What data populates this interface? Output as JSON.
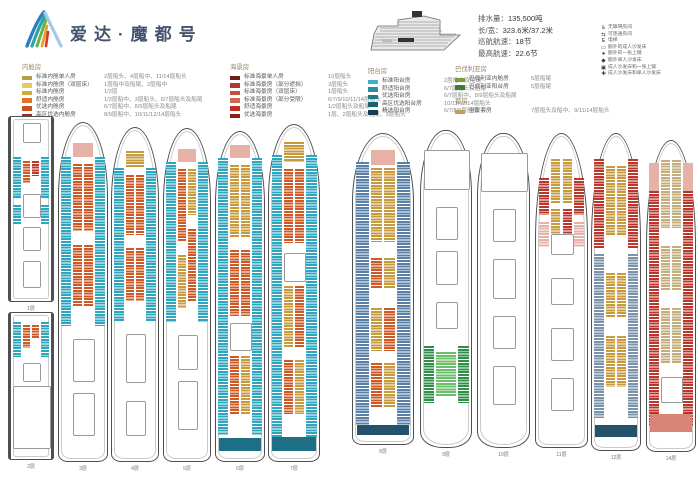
{
  "header": {
    "title": "爱达·魔都号",
    "specs": [
      {
        "label": "排水量：",
        "value": "135,500吨"
      },
      {
        "label": "长/宽：",
        "value": "323.6米/37.2米"
      },
      {
        "label": "巡航航速：",
        "value": "18节"
      },
      {
        "label": "最高航速：",
        "value": "22.6节"
      }
    ],
    "icon_legend": [
      {
        "icon": "wheelchair-icon",
        "glyph": "♿",
        "label": "无障碍房间"
      },
      {
        "icon": "connecting-rooms-icon",
        "glyph": "⇆",
        "label": "可连通房间"
      },
      {
        "icon": "elevator-icon",
        "glyph": "E",
        "label": "电梯"
      },
      {
        "icon": "sofa-bed-icon",
        "glyph": "▭",
        "label": "额外的成人沙发床"
      },
      {
        "icon": "upper-berth-icon",
        "glyph": "●",
        "label": "额外的一张上铺"
      },
      {
        "icon": "single-sofa-bed-icon",
        "glyph": "◆",
        "label": "额外单人沙发床"
      },
      {
        "icon": "sofa-and-berth-icon",
        "glyph": "▣",
        "label": "成人沙发床和一张上铺"
      },
      {
        "icon": "sofa-and-single-icon",
        "glyph": "✚",
        "label": "成人沙发床和单人沙发床"
      }
    ]
  },
  "legend_groups": [
    {
      "title": "内舱房",
      "items": [
        {
          "color": "#b2a040",
          "label": "标准内舱单人房",
          "desc": "2层船头、4层船中、11/14层船头"
        },
        {
          "color": "#e2cd58",
          "label": "标准内舱房（双层床）",
          "desc": "1层船中及船尾、2层船中"
        },
        {
          "color": "#d5a63a",
          "label": "标准内舱房",
          "desc": "1/2层"
        },
        {
          "color": "#dd7429",
          "label": "舒适内舱房",
          "desc": "1/2层船中、3层船头、6/7层船头及船尾"
        },
        {
          "color": "#c4521f",
          "label": "优选内舱房",
          "desc": "6/7层船中、8/9层船头及船尾"
        },
        {
          "color": "#9e2b1b",
          "label": "高区优选内舱房",
          "desc": "8/9层船中、10/11/12/14层船头"
        }
      ]
    },
    {
      "title": "海景房",
      "items": [
        {
          "color": "#6e1d15",
          "label": "标准海景单人房",
          "desc": "10层船头"
        },
        {
          "color": "#ae392e",
          "label": "标准海景房（部分遮挡）",
          "desc": "3层船头"
        },
        {
          "color": "#c24f40",
          "label": "标准海景房（双层床）",
          "desc": "1层船头"
        },
        {
          "color": "#cf6a52",
          "label": "标准海景房（部分受限）",
          "desc": "6/7/9/10/11/14层船头"
        },
        {
          "color": "#bb2f24",
          "label": "舒适海景房",
          "desc": "1/2层船头及船尾"
        },
        {
          "color": "#8c1e14",
          "label": "优选海景房",
          "desc": "1层、2层船头及船尾、3层船头"
        }
      ]
    },
    {
      "title": "阳台房",
      "items": [
        {
          "color": "#3eb2c2",
          "label": "标准阳台房",
          "desc": "2层船中及船尾"
        },
        {
          "color": "#2a8fa4",
          "label": "舒适阳台房",
          "desc": "6/7层船头及船尾"
        },
        {
          "color": "#1f7a8c",
          "label": "优选阳台房",
          "desc": "6/7层船中、8/9层船头及船尾"
        },
        {
          "color": "#176072",
          "label": "高区优选阳台房",
          "desc": "10/11/12/14层船头"
        },
        {
          "color": "#113f52",
          "label": "精选阳台房",
          "desc": "6/7/8/9层船尾"
        }
      ]
    },
    {
      "title": "巴伐利亚房",
      "items": [
        {
          "color": "#7c9a3a",
          "label": "巴伐利亚内舱房",
          "desc": "5层船尾"
        },
        {
          "color": "#3c7c38",
          "label": "巴伐利亚阳台房",
          "desc": "5层船尾"
        }
      ]
    },
    {
      "title": "套房",
      "items": [
        {
          "color": "#bfa058",
          "label": "全景套房",
          "desc": "7层船头及船中、9/11/14层船头"
        }
      ]
    }
  ],
  "palette": {
    "teal": "#2fa6bd",
    "slate": "#5b80a8",
    "slate2": "#7a93a8",
    "orange": "#cd5a25",
    "gold": "#c79a3e",
    "tan": "#c4ae7d",
    "red": "#b9372a",
    "red2": "#d98477",
    "pink": "#e6b1a6",
    "green": "#2f8f46",
    "green2": "#6cbf6a",
    "dark": "#1e6e86",
    "navy": "#24526b"
  },
  "decks": [
    {
      "label": "1层",
      "x": 8,
      "y": 116,
      "w": 46,
      "h": 186,
      "shape": "rect",
      "segs": [
        {
          "pos": "C",
          "c": "outline",
          "t": 3,
          "h": 10
        },
        {
          "pos": "L",
          "c": "teal",
          "t": 22,
          "h": 22
        },
        {
          "pos": "R",
          "c": "teal",
          "t": 22,
          "h": 22
        },
        {
          "pos": "CL",
          "c": "orange",
          "t": 24,
          "h": 12
        },
        {
          "pos": "CR",
          "c": "red",
          "t": 24,
          "h": 8
        },
        {
          "pos": "C",
          "c": "outline",
          "t": 42,
          "h": 12
        },
        {
          "pos": "L",
          "c": "teal",
          "t": 48,
          "h": 10
        },
        {
          "pos": "R",
          "c": "teal",
          "t": 48,
          "h": 10
        },
        {
          "pos": "C",
          "c": "outline",
          "t": 60,
          "h": 12
        },
        {
          "pos": "C",
          "c": "outline",
          "t": 78,
          "h": 14
        }
      ]
    },
    {
      "label": "2层",
      "x": 8,
      "y": 312,
      "w": 46,
      "h": 148,
      "shape": "rect",
      "segs": [
        {
          "pos": "L",
          "c": "teal",
          "t": 6,
          "h": 24
        },
        {
          "pos": "R",
          "c": "teal",
          "t": 6,
          "h": 24
        },
        {
          "pos": "CL",
          "c": "orange",
          "t": 8,
          "h": 16
        },
        {
          "pos": "CR",
          "c": "orange",
          "t": 8,
          "h": 10
        },
        {
          "pos": "C",
          "c": "outline",
          "t": 34,
          "h": 12
        },
        {
          "pos": "F",
          "c": "outline",
          "t": 50,
          "h": 42
        }
      ]
    },
    {
      "label": "3层",
      "x": 58,
      "y": 122,
      "w": 50,
      "h": 340,
      "shape": "bow",
      "segs": [
        {
          "pos": "C",
          "c": "pink",
          "t": 6,
          "h": 4,
          "solid": true
        },
        {
          "pos": "L",
          "c": "teal",
          "t": 10,
          "h": 50
        },
        {
          "pos": "R",
          "c": "teal",
          "t": 10,
          "h": 50
        },
        {
          "pos": "CL",
          "c": "orange",
          "t": 12,
          "h": 20
        },
        {
          "pos": "CR",
          "c": "orange",
          "t": 12,
          "h": 20
        },
        {
          "pos": "CL",
          "c": "orange",
          "t": 36,
          "h": 18
        },
        {
          "pos": "CR",
          "c": "orange",
          "t": 36,
          "h": 18
        },
        {
          "pos": "C",
          "c": "outline",
          "t": 64,
          "h": 12
        },
        {
          "pos": "C",
          "c": "outline",
          "t": 80,
          "h": 12
        }
      ]
    },
    {
      "label": "4层",
      "x": 111,
      "y": 127,
      "w": 48,
      "h": 335,
      "shape": "bow",
      "segs": [
        {
          "pos": "C",
          "c": "gold",
          "t": 7,
          "h": 5
        },
        {
          "pos": "L",
          "c": "teal",
          "t": 12,
          "h": 46
        },
        {
          "pos": "R",
          "c": "teal",
          "t": 12,
          "h": 46
        },
        {
          "pos": "CL",
          "c": "orange",
          "t": 14,
          "h": 18
        },
        {
          "pos": "CR",
          "c": "orange",
          "t": 14,
          "h": 18
        },
        {
          "pos": "CL",
          "c": "orange",
          "t": 36,
          "h": 16
        },
        {
          "pos": "CR",
          "c": "orange",
          "t": 36,
          "h": 16
        },
        {
          "pos": "C",
          "c": "outline",
          "t": 62,
          "h": 14
        },
        {
          "pos": "C",
          "c": "outline",
          "t": 82,
          "h": 10
        }
      ]
    },
    {
      "label": "5层",
      "x": 163,
      "y": 128,
      "w": 48,
      "h": 334,
      "shape": "bow",
      "segs": [
        {
          "pos": "C",
          "c": "pink",
          "t": 6,
          "h": 4,
          "solid": true
        },
        {
          "pos": "L",
          "c": "teal",
          "t": 10,
          "h": 48
        },
        {
          "pos": "R",
          "c": "teal",
          "t": 10,
          "h": 48
        },
        {
          "pos": "CL",
          "c": "orange",
          "t": 12,
          "h": 22
        },
        {
          "pos": "CR",
          "c": "gold",
          "t": 12,
          "h": 14
        },
        {
          "pos": "CL",
          "c": "gold",
          "t": 38,
          "h": 16
        },
        {
          "pos": "CR",
          "c": "orange",
          "t": 30,
          "h": 22
        },
        {
          "pos": "C",
          "c": "outline",
          "t": 62,
          "h": 10
        },
        {
          "pos": "C",
          "c": "outline",
          "t": 76,
          "h": 14
        }
      ]
    },
    {
      "label": "6层",
      "x": 215,
      "y": 131,
      "w": 50,
      "h": 331,
      "shape": "bow",
      "segs": [
        {
          "pos": "C",
          "c": "pink",
          "t": 4,
          "h": 4,
          "solid": true
        },
        {
          "pos": "L",
          "c": "teal",
          "t": 8,
          "h": 84
        },
        {
          "pos": "R",
          "c": "teal",
          "t": 8,
          "h": 84
        },
        {
          "pos": "CL",
          "c": "gold",
          "t": 10,
          "h": 22
        },
        {
          "pos": "CR",
          "c": "gold",
          "t": 10,
          "h": 22
        },
        {
          "pos": "CL",
          "c": "orange",
          "t": 36,
          "h": 20
        },
        {
          "pos": "CR",
          "c": "orange",
          "t": 36,
          "h": 20
        },
        {
          "pos": "C",
          "c": "outline",
          "t": 58,
          "h": 8
        },
        {
          "pos": "CL",
          "c": "orange",
          "t": 68,
          "h": 18
        },
        {
          "pos": "CR",
          "c": "gold",
          "t": 68,
          "h": 18
        },
        {
          "pos": "F",
          "c": "dark",
          "t": 93,
          "h": 4,
          "solid": true
        }
      ]
    },
    {
      "label": "7层",
      "x": 268,
      "y": 124,
      "w": 52,
      "h": 338,
      "shape": "bow",
      "segs": [
        {
          "pos": "C",
          "c": "gold",
          "t": 5,
          "h": 6
        },
        {
          "pos": "L",
          "c": "teal",
          "t": 9,
          "h": 84
        },
        {
          "pos": "R",
          "c": "teal",
          "t": 9,
          "h": 84
        },
        {
          "pos": "CL",
          "c": "orange",
          "t": 13,
          "h": 22
        },
        {
          "pos": "CR",
          "c": "orange",
          "t": 13,
          "h": 22
        },
        {
          "pos": "C",
          "c": "outline",
          "t": 38,
          "h": 8
        },
        {
          "pos": "CL",
          "c": "gold",
          "t": 48,
          "h": 18
        },
        {
          "pos": "CR",
          "c": "orange",
          "t": 48,
          "h": 18
        },
        {
          "pos": "CL",
          "c": "orange",
          "t": 70,
          "h": 16
        },
        {
          "pos": "CR",
          "c": "gold",
          "t": 70,
          "h": 16
        },
        {
          "pos": "F",
          "c": "dark",
          "t": 93,
          "h": 4,
          "solid": true
        }
      ]
    },
    {
      "label": "8层",
      "x": 352,
      "y": 133,
      "w": 62,
      "h": 312,
      "shape": "bow",
      "segs": [
        {
          "pos": "C",
          "c": "pink",
          "t": 5,
          "h": 5,
          "solid": true
        },
        {
          "pos": "L",
          "c": "slate",
          "t": 9,
          "h": 85
        },
        {
          "pos": "R",
          "c": "slate",
          "t": 9,
          "h": 85
        },
        {
          "pos": "CL",
          "c": "gold",
          "t": 11,
          "h": 24
        },
        {
          "pos": "CR",
          "c": "gold",
          "t": 11,
          "h": 24
        },
        {
          "pos": "CL",
          "c": "orange",
          "t": 40,
          "h": 10
        },
        {
          "pos": "CR",
          "c": "gold",
          "t": 40,
          "h": 10
        },
        {
          "pos": "CL",
          "c": "gold",
          "t": 56,
          "h": 14
        },
        {
          "pos": "CR",
          "c": "orange",
          "t": 56,
          "h": 14
        },
        {
          "pos": "CL",
          "c": "orange",
          "t": 74,
          "h": 14
        },
        {
          "pos": "CR",
          "c": "gold",
          "t": 74,
          "h": 14
        },
        {
          "pos": "F",
          "c": "navy",
          "t": 94,
          "h": 3,
          "solid": true
        }
      ]
    },
    {
      "label": "9层",
      "x": 420,
      "y": 130,
      "w": 52,
      "h": 318,
      "shape": "bow3",
      "segs": [
        {
          "pos": "F",
          "c": "outline",
          "t": 6,
          "h": 12
        },
        {
          "pos": "C",
          "c": "outline",
          "t": 24,
          "h": 10
        },
        {
          "pos": "C",
          "c": "outline",
          "t": 38,
          "h": 10
        },
        {
          "pos": "C",
          "c": "outline",
          "t": 54,
          "h": 8
        },
        {
          "pos": "L",
          "c": "green",
          "t": 68,
          "h": 18
        },
        {
          "pos": "R",
          "c": "green",
          "t": 68,
          "h": 18
        },
        {
          "pos": "C",
          "c": "green2",
          "t": 70,
          "h": 14
        }
      ]
    },
    {
      "label": "10层",
      "x": 477,
      "y": 133,
      "w": 53,
      "h": 315,
      "shape": "bow3",
      "segs": [
        {
          "pos": "F",
          "c": "outline",
          "t": 6,
          "h": 12
        },
        {
          "pos": "C",
          "c": "outline",
          "t": 24,
          "h": 10
        },
        {
          "pos": "C",
          "c": "outline",
          "t": 40,
          "h": 12
        },
        {
          "pos": "C",
          "c": "outline",
          "t": 58,
          "h": 10
        },
        {
          "pos": "C",
          "c": "outline",
          "t": 74,
          "h": 12
        }
      ]
    },
    {
      "label": "11层",
      "x": 535,
      "y": 133,
      "w": 53,
      "h": 315,
      "shape": "bow2",
      "segs": [
        {
          "pos": "CL",
          "c": "gold",
          "t": 8,
          "h": 14
        },
        {
          "pos": "CR",
          "c": "gold",
          "t": 8,
          "h": 14
        },
        {
          "pos": "L",
          "c": "red",
          "t": 14,
          "h": 12
        },
        {
          "pos": "R",
          "c": "red",
          "t": 14,
          "h": 12
        },
        {
          "pos": "CL",
          "c": "gold",
          "t": 24,
          "h": 8
        },
        {
          "pos": "CR",
          "c": "red",
          "t": 24,
          "h": 8
        },
        {
          "pos": "L",
          "c": "pink",
          "t": 28,
          "h": 8
        },
        {
          "pos": "R",
          "c": "pink",
          "t": 28,
          "h": 8
        },
        {
          "pos": "C",
          "c": "outline",
          "t": 32,
          "h": 6
        },
        {
          "pos": "C",
          "c": "outline",
          "t": 46,
          "h": 8
        },
        {
          "pos": "C",
          "c": "outline",
          "t": 62,
          "h": 10
        },
        {
          "pos": "C",
          "c": "outline",
          "t": 78,
          "h": 10
        }
      ]
    },
    {
      "label": "12层",
      "x": 591,
      "y": 133,
      "w": 50,
      "h": 318,
      "shape": "bow2",
      "segs": [
        {
          "pos": "L",
          "c": "red",
          "t": 8,
          "h": 28
        },
        {
          "pos": "R",
          "c": "red",
          "t": 8,
          "h": 28
        },
        {
          "pos": "CL",
          "c": "gold",
          "t": 10,
          "h": 22
        },
        {
          "pos": "CR",
          "c": "gold",
          "t": 10,
          "h": 22
        },
        {
          "pos": "L",
          "c": "slate2",
          "t": 38,
          "h": 52
        },
        {
          "pos": "R",
          "c": "slate2",
          "t": 38,
          "h": 52
        },
        {
          "pos": "CL",
          "c": "gold",
          "t": 44,
          "h": 14
        },
        {
          "pos": "CR",
          "c": "gold",
          "t": 44,
          "h": 14
        },
        {
          "pos": "CL",
          "c": "gold",
          "t": 64,
          "h": 16
        },
        {
          "pos": "CR",
          "c": "gold",
          "t": 64,
          "h": 16
        },
        {
          "pos": "F",
          "c": "navy",
          "t": 92,
          "h": 4,
          "solid": true
        }
      ]
    },
    {
      "label": "14层",
      "x": 646,
      "y": 140,
      "w": 50,
      "h": 312,
      "shape": "bow2",
      "segs": [
        {
          "pos": "L",
          "c": "pink",
          "t": 7,
          "h": 9,
          "solid": true
        },
        {
          "pos": "R",
          "c": "pink",
          "t": 7,
          "h": 9,
          "solid": true
        },
        {
          "pos": "CL",
          "c": "tan",
          "t": 6,
          "h": 22
        },
        {
          "pos": "CR",
          "c": "tan",
          "t": 6,
          "h": 22
        },
        {
          "pos": "L",
          "c": "red",
          "t": 16,
          "h": 76
        },
        {
          "pos": "R",
          "c": "red",
          "t": 16,
          "h": 76
        },
        {
          "pos": "CL",
          "c": "tan",
          "t": 34,
          "h": 14
        },
        {
          "pos": "CR",
          "c": "tan",
          "t": 34,
          "h": 14
        },
        {
          "pos": "CL",
          "c": "tan",
          "t": 54,
          "h": 18
        },
        {
          "pos": "CR",
          "c": "tan",
          "t": 54,
          "h": 18
        },
        {
          "pos": "C",
          "c": "outline",
          "t": 76,
          "h": 8
        },
        {
          "pos": "F",
          "c": "red2",
          "t": 88,
          "h": 6,
          "solid": true
        }
      ]
    }
  ]
}
